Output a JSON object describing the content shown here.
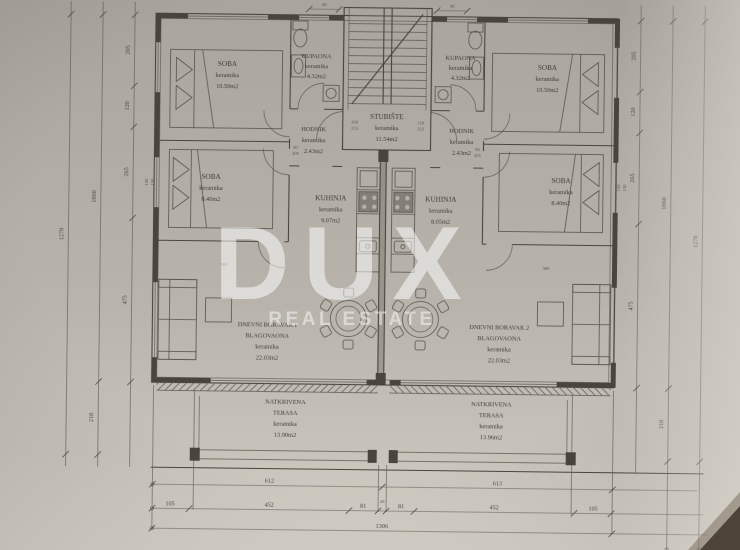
{
  "watermark": {
    "title": "DUX",
    "subtitle": "REAL ESTATE"
  },
  "common": {
    "stubiste": {
      "name": "STUBIŠTE",
      "material": "keramika",
      "area": "11.54m2"
    }
  },
  "units": {
    "left": {
      "soba1": {
        "name": "SOBA",
        "material": "keramika",
        "area": "10.50m2"
      },
      "kupaona": {
        "name": "KUPAONA",
        "material": "keramika",
        "area": "4.32m2"
      },
      "hodnik": {
        "name": "HODNIK",
        "material": "keramika",
        "area": "2.43m2"
      },
      "soba2": {
        "name": "SOBA",
        "material": "keramika",
        "area": "8.40m2"
      },
      "kuhinja": {
        "name": "KUHINJA",
        "material": "keramika",
        "area": "9.07m2"
      },
      "dnevni": {
        "line1": "DNEVNI BORAVAK I",
        "line2": "BLAGOVAONA",
        "material": "keramika",
        "area": "22.03m2"
      },
      "terasa": {
        "line1": "NATKRIVENA",
        "line2": "TERASA",
        "material": "keramika",
        "area": "13.90m2"
      }
    },
    "right": {
      "soba1": {
        "name": "SOBA",
        "material": "keramika",
        "area": "10.50m2"
      },
      "kupaona": {
        "name": "KUPAONA",
        "material": "keramika",
        "area": "4.32m2"
      },
      "hodnik": {
        "name": "HODNIK",
        "material": "keramika",
        "area": "2.43m2"
      },
      "soba2": {
        "name": "SOBA",
        "material": "keramika",
        "area": "8.40m2"
      },
      "kuhinja": {
        "name": "KUHINJA",
        "material": "keramika",
        "area": "8.05m2"
      },
      "dnevni": {
        "line1": "DNEVNI BORAVAK 2",
        "line2": "BLAGOVAONA",
        "material": "keramika",
        "area": "22.03m2"
      },
      "terasa": {
        "line1": "NATKRIVENA",
        "line2": "TERASA",
        "material": "keramika",
        "area": "13.96m2"
      }
    }
  },
  "dimensions": {
    "bottom": {
      "row1": [
        "612",
        "613"
      ],
      "row2": [
        "105",
        "452",
        "81",
        "20",
        "81",
        "452",
        "105"
      ],
      "total": "1306"
    },
    "left": {
      "segments": [
        "205",
        "120",
        "265",
        "475"
      ],
      "inner_total": "1060",
      "terrace": "218",
      "total": "1278"
    },
    "right": {
      "segments": [
        "205",
        "120",
        "265",
        "475"
      ],
      "inner_total": "1060",
      "terrace": "218",
      "total": "1278"
    },
    "top": {
      "left_door": "90",
      "right_door": "90"
    },
    "annotations": {
      "window_left": "300",
      "window_right": "300",
      "door_left_w": "90",
      "door_left_h": "205",
      "door_right_w": "90",
      "door_right_h": "205",
      "stair_left_w": "410",
      "stair_left_h": "213",
      "stair_right_w": "110",
      "stair_right_h": "213",
      "glass_left_w": "120",
      "glass_left_h": "150",
      "glass_right_w": "120",
      "glass_right_h": "150"
    }
  },
  "colors": {
    "paper": "#b4b0a8",
    "ink": "#48443d",
    "watermark": "#ffffff"
  }
}
